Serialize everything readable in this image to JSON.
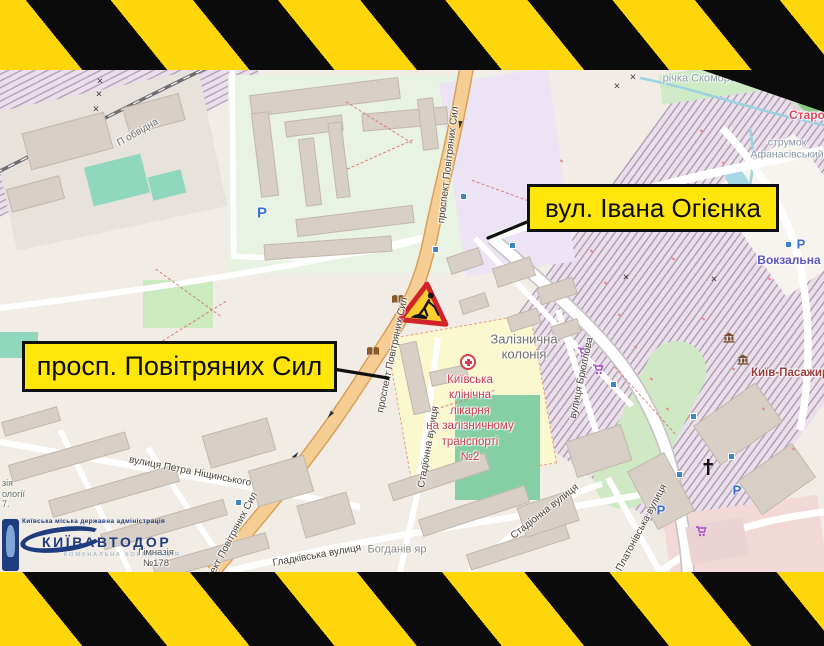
{
  "colors": {
    "hazard_yellow": "#FFD60A",
    "hazard_black": "#0B0B0B",
    "callout_yellow": "#FFE60A",
    "callout_border": "#101010",
    "map_bg": "#F1EDE6",
    "road_orange": "#F6CE93",
    "rail_pink": "#ECDEED",
    "park_green": "#CBEAC0",
    "pitch_teal": "#8FD7BD",
    "hospital_yellow": "#FAF8CE",
    "retail_pink": "#F2D9D8",
    "water_teal": "#9CD3E0",
    "station_red": "#E0455E",
    "metro_blue": "#5A54C8",
    "rail_station_brown": "#9E3B3B",
    "hospital_red": "#C93B4C",
    "logo_navy": "#1F3C7E"
  },
  "callouts": [
    {
      "text": "вул. Івана Огієнка"
    },
    {
      "text": "просп. Повітряних Сил"
    }
  ],
  "streets": {
    "prospekt": "проспект Повітряних Сил",
    "stadionna": "Стадіонна вулиця",
    "nishchynskoho": "вулиця Петра Ніщинського",
    "hladkivska": "Гладківська вулиця",
    "briullova": "вулиця Брюллова",
    "platonivska": "Платонівська вулиця",
    "pobvidna": "П обвідна"
  },
  "places": {
    "richka": "річка Скоморох",
    "strumok": "струмок\nАфанасівський",
    "staro": "Старо",
    "vokzalna": "Вокзальна",
    "kyiv_pas": "Київ-Пасажир",
    "zaliznychna": "Залізнична\nколонія",
    "bohdaniv": "Богданів яр",
    "himnaziya": "Гімназія\n№178",
    "fragments": "зія\nології\n7."
  },
  "hospital": {
    "name": "Київська\nклінічна\nлікарня\nна залізничному\nтранспорті\n№2"
  },
  "logo": {
    "admin": "Київська міська державна адміністрація",
    "title": "КИЇВАВТОДОР",
    "subtitle": "КОМУНАЛЬНА КОРПОРАЦІЯ"
  },
  "glyphs": {
    "parking": "Р",
    "crossing": "×"
  }
}
